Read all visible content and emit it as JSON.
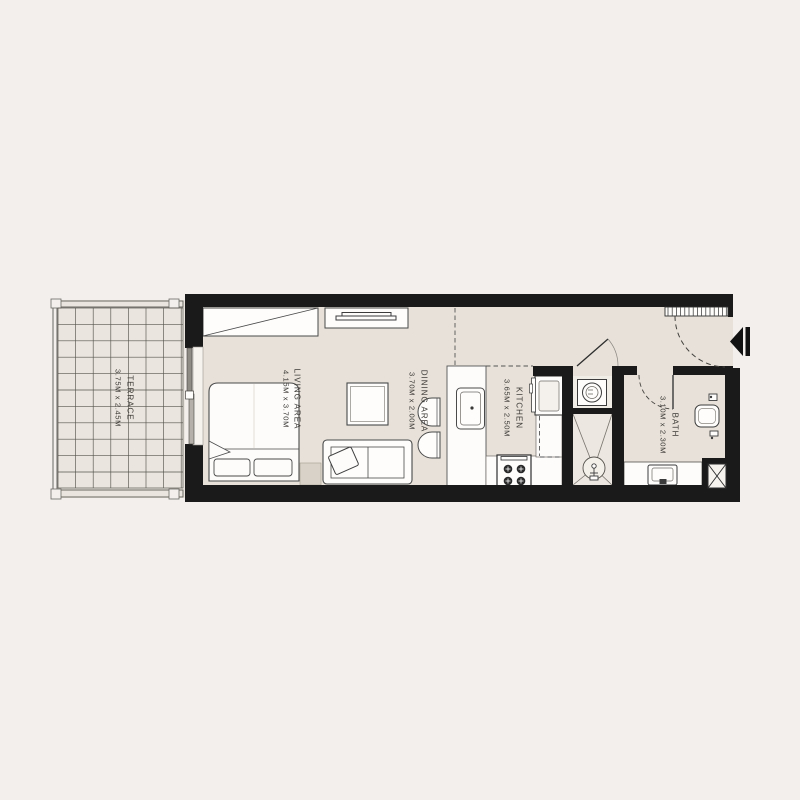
{
  "floorplan": {
    "rooms": [
      {
        "name": "TERRACE",
        "dims": "3.75M x 2.45M"
      },
      {
        "name": "LIVING AREA",
        "dims": "4.15M x 3.70M"
      },
      {
        "name": "DINING AREA",
        "dims": "3.70M x 2.00M"
      },
      {
        "name": "KITCHEN",
        "dims": "3.65M x 2.50M"
      },
      {
        "name": "BATH",
        "dims": "3.10M x 2.30M"
      }
    ],
    "colors": {
      "background": "#f2efec",
      "floor": "#e7e1d9",
      "terrace_floor": "#eae5de",
      "wall": "#1a1a1a",
      "furniture_fill": "#fefdfc",
      "line": "#4a4a4a",
      "text": "#3c3935"
    }
  }
}
